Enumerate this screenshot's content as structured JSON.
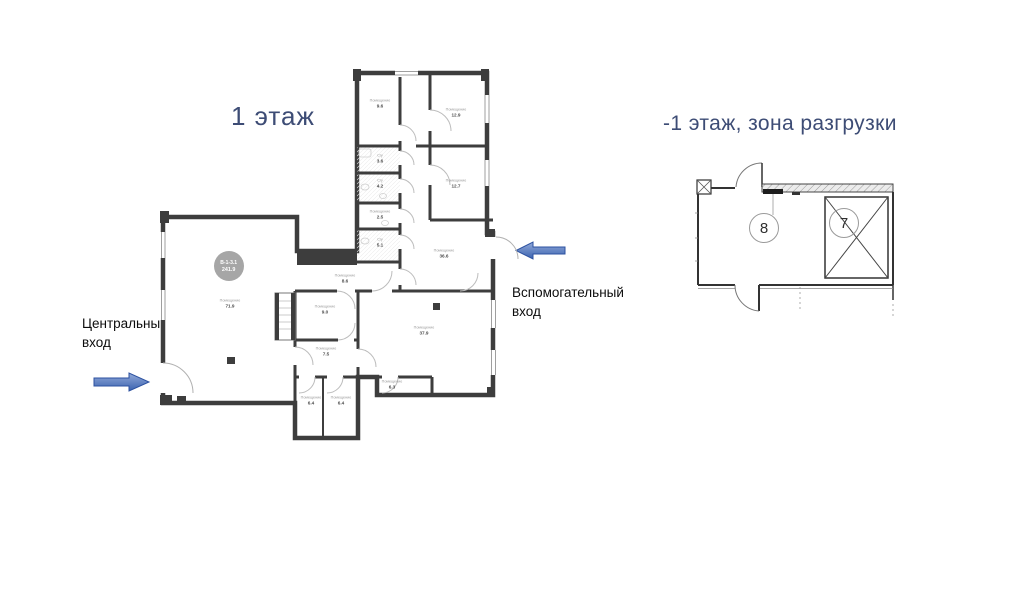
{
  "titles": {
    "left": "1 этаж",
    "right": "-1 этаж, зона разгрузки"
  },
  "annotations": {
    "central_entrance": "Центральный\nвход",
    "auxiliary_entrance": "Вспомогательный\nвход"
  },
  "unit_badge": {
    "code": "В-1-3.1",
    "total_area": "241.9"
  },
  "left_plan": {
    "rooms": [
      {
        "name": "Помещение",
        "area": "9.6"
      },
      {
        "name": "Помещение",
        "area": "12.9"
      },
      {
        "name": "С/у",
        "area": "3.6"
      },
      {
        "name": "С/у",
        "area": "4.2"
      },
      {
        "name": "Помещение",
        "area": "12.7"
      },
      {
        "name": "Помещение",
        "area": "2.5"
      },
      {
        "name": "С/у",
        "area": "5.1"
      },
      {
        "name": "Помещение",
        "area": "36.6"
      },
      {
        "name": "Помещение",
        "area": "8.6"
      },
      {
        "name": "Помещение",
        "area": "71.9"
      },
      {
        "name": "Помещение",
        "area": "9.0"
      },
      {
        "name": "Помещение",
        "area": "37.9"
      },
      {
        "name": "Помещение",
        "area": "7.5"
      },
      {
        "name": "Помещение",
        "area": "6.3"
      },
      {
        "name": "Помещение",
        "area": "6.4"
      },
      {
        "name": "Помещение",
        "area": "6.4"
      }
    ]
  },
  "right_plan": {
    "zones": [
      {
        "number": "8"
      },
      {
        "number": "7"
      }
    ]
  },
  "colors": {
    "title": "#3d4c75",
    "wall": "#3d3d3d",
    "arrow_dark": "#3a62af",
    "arrow_light": "#93aad9",
    "badge": "#a6a6a6"
  }
}
